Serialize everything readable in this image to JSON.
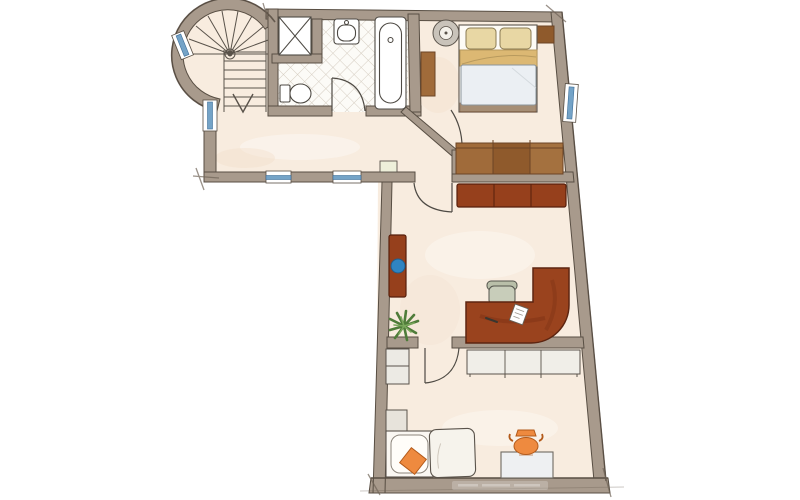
{
  "meta": {
    "description": "Hand-drawn watercolor architectural floor plan of an L-shaped apartment storey with a round spiral-staircase tower, bathroom, hallway, bedroom, study and guest room",
    "visible_text": "none (illegible faint watermark strip in bottom wall)"
  },
  "colors": {
    "bg": "#ffffff",
    "floor": "#f8ecdf",
    "floor-blotch-warm": "#f1dcc7",
    "wall": "#a89a8c",
    "wall-line": "#584e43",
    "wall-accent": "#6f6357",
    "tile-bg": "#fcfbf7",
    "tile-line": "#d5cdc1",
    "window-blue": "#74a3c7",
    "window-blue-line": "#3f6f99",
    "window-frame": "#ffffff",
    "fixture": "#ffffff",
    "fixture-line": "#4e4a44",
    "stair-line": "#5a534b",
    "wood": "#a06b3a",
    "wood-mid": "#8f5a2c",
    "wood-light": "#a4713f",
    "wood-line": "#6b4426",
    "sideboard": "#96401c",
    "red-line": "#571f0c",
    "desk": "#9a431e",
    "desk-line": "#5c2410",
    "desk-streak": "#7c3115",
    "pillow": "#e8d7a4",
    "pillow-line": "#8a7b54",
    "blanket": "#dcb873",
    "blanket-line": "#b89a5e",
    "duvet": "#ebeff3",
    "duvet-line": "#8b949b",
    "chair": "#c8cdba",
    "chair-back": "#b9bfa9",
    "chair-line": "#54544c",
    "plant-dark": "#4f7c3a",
    "plant-light": "#7aa85c",
    "accent-blue": "#2f84c2",
    "accent-blue-line": "#225d8a",
    "orange": "#ee8a3f",
    "orange-line": "#b35a1a",
    "cabinet": "#eceae4",
    "cabinet-grey": "#e7e3db",
    "counter": "#f0eee8",
    "table-grey": "#eef0f2",
    "radiator": "#eef0da",
    "bedframe": "#8a6a4a"
  },
  "rooms": [
    {
      "name": "stair-tower",
      "feature": "spiral staircase with straight run and down arrow"
    },
    {
      "name": "bathroom",
      "feature": "diamond tiled floor, shower niche, sink, bathtub, toilet"
    },
    {
      "name": "hallway",
      "feature": "two windows in south wall, radiator"
    },
    {
      "name": "bedroom",
      "feature": "double bed, two nightstands, round side table, wardrobe wall"
    },
    {
      "name": "study",
      "feature": "sideboard, bench with round blue cushion, curved corner desk with office chair, plant, two dashed furniture outlines"
    },
    {
      "name": "guest-room",
      "feature": "cabinets, counter row, single bed with orange pillow, day bed, table with orange vase, dashed outline"
    }
  ],
  "furniture": [
    "spiral-staircase",
    "shower-niche",
    "sink",
    "bathtub",
    "toilet",
    "radiator",
    "round-side-table",
    "double-bed",
    "nightstand-left",
    "nightstand-right",
    "wardrobe",
    "sideboard",
    "bench-sofa",
    "blue-cushion",
    "corner-desk",
    "office-chair",
    "paper-sheet",
    "plant",
    "cabinet",
    "grey-cabinet",
    "counter-row",
    "single-bed",
    "orange-pillow",
    "day-bed",
    "side-table",
    "vase"
  ],
  "windows": [
    {
      "location": "tower-curve-west"
    },
    {
      "location": "hallway-west-wall"
    },
    {
      "location": "hallway-south-wall-1"
    },
    {
      "location": "hallway-south-wall-2"
    },
    {
      "location": "bedroom-east-wall"
    }
  ],
  "doors": [
    {
      "location": "bathroom"
    },
    {
      "location": "bedroom-diagonal-corner"
    },
    {
      "location": "study"
    },
    {
      "location": "guest-room"
    }
  ]
}
